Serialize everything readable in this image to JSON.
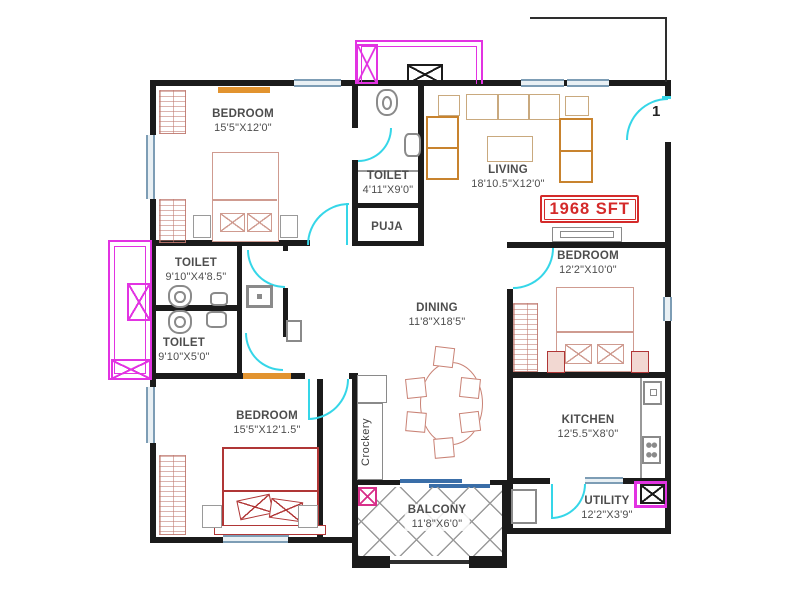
{
  "plan": {
    "area_badge": "1968 SFT",
    "door_number": "1",
    "rooms": {
      "bedroom1": {
        "name": "BEDROOM",
        "dims": "15'5\"X12'0\""
      },
      "toilet1": {
        "name": "TOILET",
        "dims": "4'11\"X9'0\""
      },
      "puja": {
        "name": "PUJA"
      },
      "living": {
        "name": "LIVING",
        "dims": "18'10.5\"X12'0\""
      },
      "bedroom2": {
        "name": "BEDROOM",
        "dims": "12'2\"X10'0\""
      },
      "toilet2": {
        "name": "TOILET",
        "dims": "9'10\"X4'8.5\""
      },
      "toilet3": {
        "name": "TOILET",
        "dims": "9'10\"X5'0\""
      },
      "dining": {
        "name": "DINING",
        "dims": "11'8\"X18'5\""
      },
      "bedroom3": {
        "name": "BEDROOM",
        "dims": "15'5\"X12'1.5\""
      },
      "crockery": {
        "name": "Crockery"
      },
      "kitchen": {
        "name": "KITCHEN",
        "dims": "12'5.5\"X8'0\""
      },
      "utility": {
        "name": "UTILITY",
        "dims": "12'2\"X3'9\""
      },
      "balcony": {
        "name": "BALCONY",
        "dims": "11'8\"X6'0\""
      }
    },
    "colors": {
      "wall": "#1b1b1b",
      "door": "#35d6e8",
      "window": "#7d9db5",
      "duct": "#e233e2",
      "accent_red": "#d42a2a",
      "sofa_orange": "#c8832e",
      "furniture_tan": "#c9a97e",
      "bed_light": "#cf9b90",
      "bed_dark": "#b03636",
      "fixture_gray": "#8a8a8a",
      "lintel_orange": "#e2932f"
    }
  }
}
